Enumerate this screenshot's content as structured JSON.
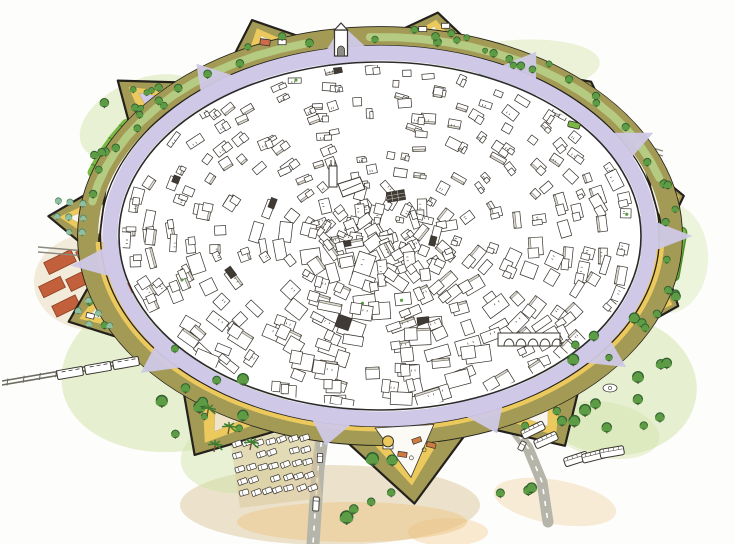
{
  "meta": {
    "subject": "Hand-drawn watercolor aerial illustration of a circular walled old city with star-fort bastions, inner building maze, ring road, gardens, railway, car park and bus park",
    "canvas": {
      "w": 734,
      "h": 544
    }
  },
  "palette": {
    "paper": "#fdfdfb",
    "ink": "#39342e",
    "wallInk": "#24211d",
    "olive": "#a39a55",
    "oliveDeep": "#77703f",
    "yellow": "#ecc95d",
    "stallOrange": "#cf7a3e",
    "lavender": "#cfc8e6",
    "roadGray": "#b5b5aa",
    "roadLine": "#8a8a80",
    "greenWash": "#cfe2a4",
    "gardenGreen": "#b9d78d",
    "greenBright": "#79b844",
    "greenDark": "#4e8f2c",
    "treeGreen": "#5d9c44",
    "treeDark": "#2f6030",
    "teal": "#8fbf9f",
    "tealDark": "#4e8060",
    "pondBlue": "#c3e2e4",
    "pondPink": "#e8b7a8",
    "terracotta": "#c2603c",
    "terraDark": "#8f3d22",
    "sandWash": "#dcc89c",
    "orangeWash": "#eec27f",
    "clay": "#e7b078",
    "trainGray": "#6b6b60",
    "trunk": "#6b5436",
    "white": "#ffffff",
    "interiorLight": "#f7f5ec",
    "plazaWhite": "#fbfaf5",
    "shadeGray": "#d8d6cc",
    "darkRoof": "#3f3b34"
  },
  "scene": {
    "seed": 20240601,
    "center": {
      "x": 380,
      "y": 236
    },
    "wall": {
      "rx": 292,
      "ry": 199,
      "band": 20,
      "halfWidthDeg": 11
    },
    "ringRoad": {
      "rx": 270,
      "ry": 183,
      "width": 15
    },
    "innerCity": {
      "rx": 261,
      "ry": 174
    },
    "bastionAngles": [
      -175,
      -139,
      -112,
      -80,
      -47,
      -11,
      19,
      59,
      85,
      120,
      158
    ],
    "bastionLens": {
      "-175": 1.14,
      "-139": 1.19,
      "-112": 1.17,
      "-80": 1.14,
      "-47": 1.06,
      "-11": 1.06,
      "19": 1.08,
      "59": 1.23,
      "85": 1.35,
      "120": 1.27,
      "158": 1.15
    },
    "bastionInterior": {
      "-139": "lavender",
      "120": "#efe3c8",
      "85": "#fbfaf5"
    },
    "gateAngles": [
      -126,
      -97,
      -60,
      -29,
      0,
      38,
      68,
      100,
      140,
      172
    ],
    "gardenArcs": [
      [
        -170,
        -102
      ],
      [
        -92,
        -14
      ]
    ],
    "rampartTreeAngles": [
      -168,
      -161,
      -154,
      -147,
      -133,
      -126,
      -119,
      -104,
      -91,
      -75,
      -67,
      -58,
      -42,
      -33,
      -22,
      -15,
      -4,
      7,
      27,
      38
    ],
    "washes": [
      [
        185,
        365,
        125,
        85,
        -12,
        "greenWash",
        0.5
      ],
      [
        330,
        505,
        150,
        40,
        0,
        "sandWash",
        0.5
      ],
      [
        612,
        385,
        85,
        70,
        8,
        "greenWash",
        0.5
      ],
      [
        668,
        258,
        40,
        55,
        0,
        "greenWash",
        0.35
      ],
      [
        142,
        118,
        66,
        38,
        -24,
        "greenWash",
        0.45
      ],
      [
        515,
        68,
        85,
        28,
        -4,
        "greenWash",
        0.4
      ],
      [
        92,
        282,
        58,
        48,
        0,
        "sandWash",
        0.35
      ],
      [
        352,
        522,
        115,
        20,
        0,
        "orangeWash",
        0.45
      ],
      [
        555,
        502,
        62,
        22,
        10,
        "orangeWash",
        0.3
      ],
      [
        448,
        532,
        40,
        14,
        0,
        "orangeWash",
        0.35
      ],
      [
        250,
        452,
        70,
        40,
        -10,
        "greenWash",
        0.45
      ],
      [
        605,
        430,
        55,
        28,
        10,
        "greenWash",
        0.4
      ]
    ],
    "terracotta": [
      [
        60,
        262,
        30,
        13
      ],
      [
        90,
        252,
        26,
        12
      ],
      [
        52,
        287,
        24,
        12
      ],
      [
        82,
        279,
        30,
        13
      ],
      [
        66,
        306,
        26,
        12
      ],
      [
        98,
        300,
        22,
        11
      ],
      [
        124,
        291,
        18,
        10
      ]
    ],
    "field": {
      "x": 666,
      "y": 252,
      "w": 34,
      "h": 54,
      "rot": 10
    },
    "hedge": {
      "a0": -162,
      "a1": -146,
      "k": 1.035
    },
    "ponds": [
      [
        492,
        70,
        15,
        7
      ],
      [
        523,
        66,
        18,
        8
      ],
      [
        550,
        73,
        11,
        5
      ],
      [
        567,
        80,
        8,
        4
      ]
    ],
    "bastionPond": [
      228,
      72,
      12,
      6
    ],
    "court": [
      166,
      102,
      26,
      12,
      -20
    ],
    "train": {
      "p0": [
        2,
        381
      ],
      "p1": [
        150,
        356
      ],
      "p2": [
        292,
        329
      ],
      "cars": [
        [
          70,
          373
        ],
        [
          98,
          368
        ],
        [
          126,
          363
        ]
      ],
      "angle": -10
    },
    "roads": {
      "main": [
        [
          323,
          430
        ],
        [
          318,
          468
        ],
        [
          313,
          544
        ]
      ],
      "southeast": [
        [
          504,
          416
        ],
        [
          528,
          448
        ],
        [
          542,
          482
        ],
        [
          548,
          522
        ]
      ],
      "left": [
        [
          38,
          247
        ],
        [
          97,
          252
        ]
      ],
      "northeast": [
        [
          612,
          136
        ],
        [
          663,
          151
        ]
      ]
    },
    "parking": {
      "corner": [
        236,
        444
      ],
      "colStep": [
        11.4,
        -1.0
      ],
      "rowStep": [
        2.0,
        12.2
      ],
      "rows": 5,
      "cols": 7,
      "angle": -18
    },
    "buses": [
      [
        546,
        440,
        -24
      ],
      [
        576,
        459,
        -18
      ],
      [
        594,
        456,
        -14
      ],
      [
        612,
        452,
        -10
      ],
      [
        533,
        430,
        -26
      ]
    ],
    "cars": [
      [
        320,
        458,
        2,
        "car"
      ],
      [
        316,
        504,
        3,
        "truck"
      ],
      [
        522,
        446,
        28,
        "car"
      ],
      [
        574,
        125,
        14,
        "minibus"
      ]
    ],
    "palms": [
      [
        207,
        416
      ],
      [
        228,
        434
      ],
      [
        250,
        450
      ],
      [
        214,
        452
      ]
    ],
    "fountain": [
      610,
      388
    ],
    "treeRegions": [
      [
        185,
        392,
        90,
        55,
        9,
        1.1
      ],
      [
        612,
        378,
        62,
        50,
        11,
        1.05
      ],
      [
        655,
        300,
        28,
        26,
        4,
        1.0
      ],
      [
        368,
        492,
        26,
        40,
        6,
        1.15
      ],
      [
        512,
        487,
        20,
        20,
        3,
        1.1
      ],
      [
        128,
        106,
        40,
        18,
        5,
        0.85
      ],
      [
        520,
        59,
        46,
        9,
        5,
        0.8
      ],
      [
        452,
        42,
        24,
        9,
        3,
        0.8
      ],
      [
        96,
        146,
        16,
        12,
        3,
        0.9
      ],
      [
        615,
        418,
        30,
        14,
        3,
        1.05
      ]
    ],
    "buildings": {
      "rings": [
        0.97,
        0.885,
        0.8,
        0.715,
        0.63,
        0.545,
        0.46,
        0.375,
        0.29,
        0.205,
        0.12
      ],
      "density": 62,
      "extraCenter": 44
    },
    "church": {
      "x": 330,
      "y": 166
    },
    "market": [
      396,
      196
    ],
    "arcade": {
      "x": 498,
      "y": 333,
      "w": 62,
      "h": 13,
      "arches": 5
    },
    "gateTower": {
      "x": 334.5,
      "y": 30
    }
  }
}
